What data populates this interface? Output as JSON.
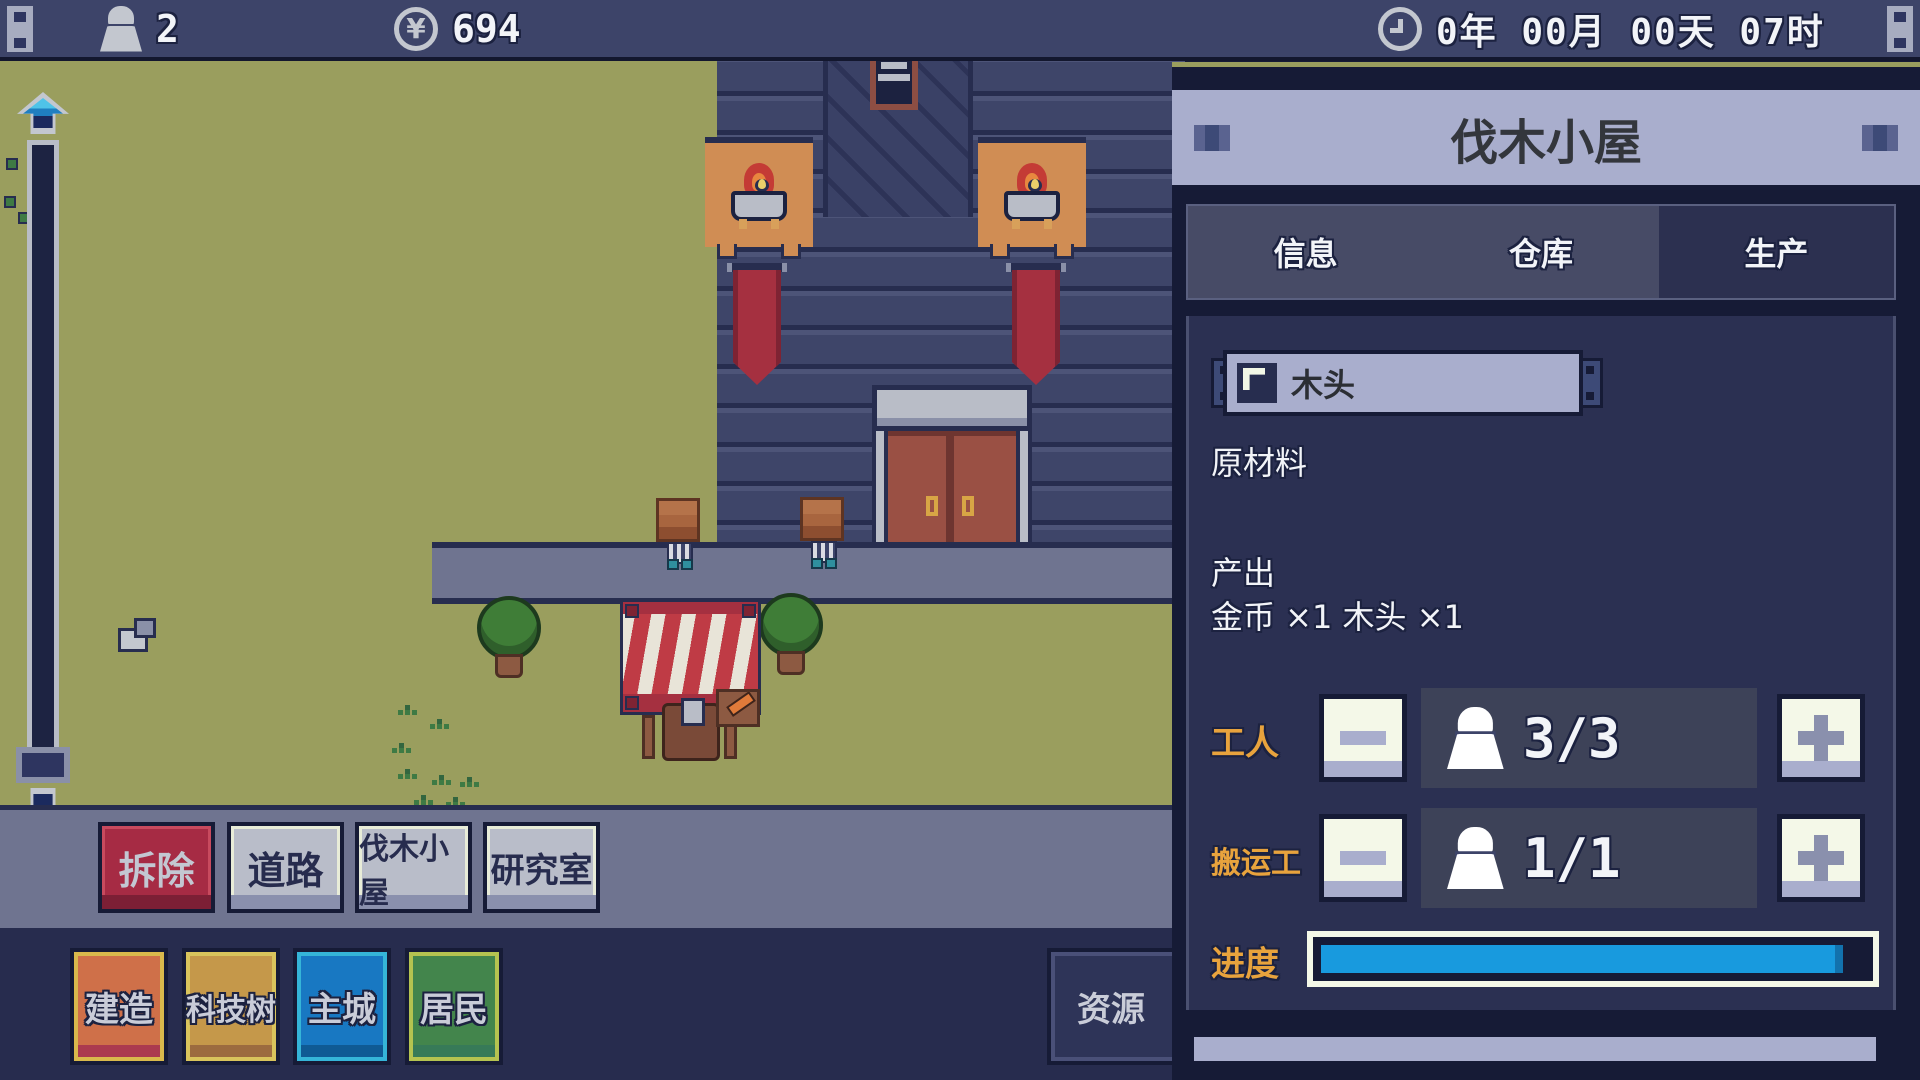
{
  "top_bar": {
    "population": "2",
    "money": "694",
    "time": "0年 00月 00天 07时",
    "icons": [
      "worker-icon",
      "coin-icon",
      "clock-icon"
    ]
  },
  "panel": {
    "title": "伐木小屋",
    "tabs": [
      {
        "label": "信息",
        "active": false
      },
      {
        "label": "仓库",
        "active": false
      },
      {
        "label": "生产",
        "active": true
      }
    ],
    "item": {
      "name": "木头",
      "category": "原材料",
      "icon": "flag-icon"
    },
    "output": {
      "label": "产出",
      "detail": "金币 ×1 木头 ×1"
    },
    "workers": {
      "label": "工人",
      "count": "3/3"
    },
    "porters": {
      "label": "搬运工",
      "count": "1/1"
    },
    "progress": {
      "label": "进度",
      "percent": "96%"
    }
  },
  "build_menu": [
    {
      "label": "拆除",
      "style": "red"
    },
    {
      "label": "道路",
      "style": "gray"
    },
    {
      "label": "伐木小屋",
      "style": "gray"
    },
    {
      "label": "研究室",
      "style": "gray"
    }
  ],
  "bottom_menu": [
    {
      "label": "建造",
      "color": "#cf7049"
    },
    {
      "label": "科技树",
      "color": "#c5984a"
    },
    {
      "label": "主城",
      "color": "#1878c2"
    },
    {
      "label": "居民",
      "color": "#43854c"
    },
    {
      "label": "资源",
      "color": "#2e3458",
      "note": "partially hidden behind panel"
    }
  ],
  "colors": {
    "progress_fill": "#189ade",
    "accent_label": "#e8a33d",
    "panel_bg": "#2b3052",
    "grass": "#9a9e5e"
  }
}
